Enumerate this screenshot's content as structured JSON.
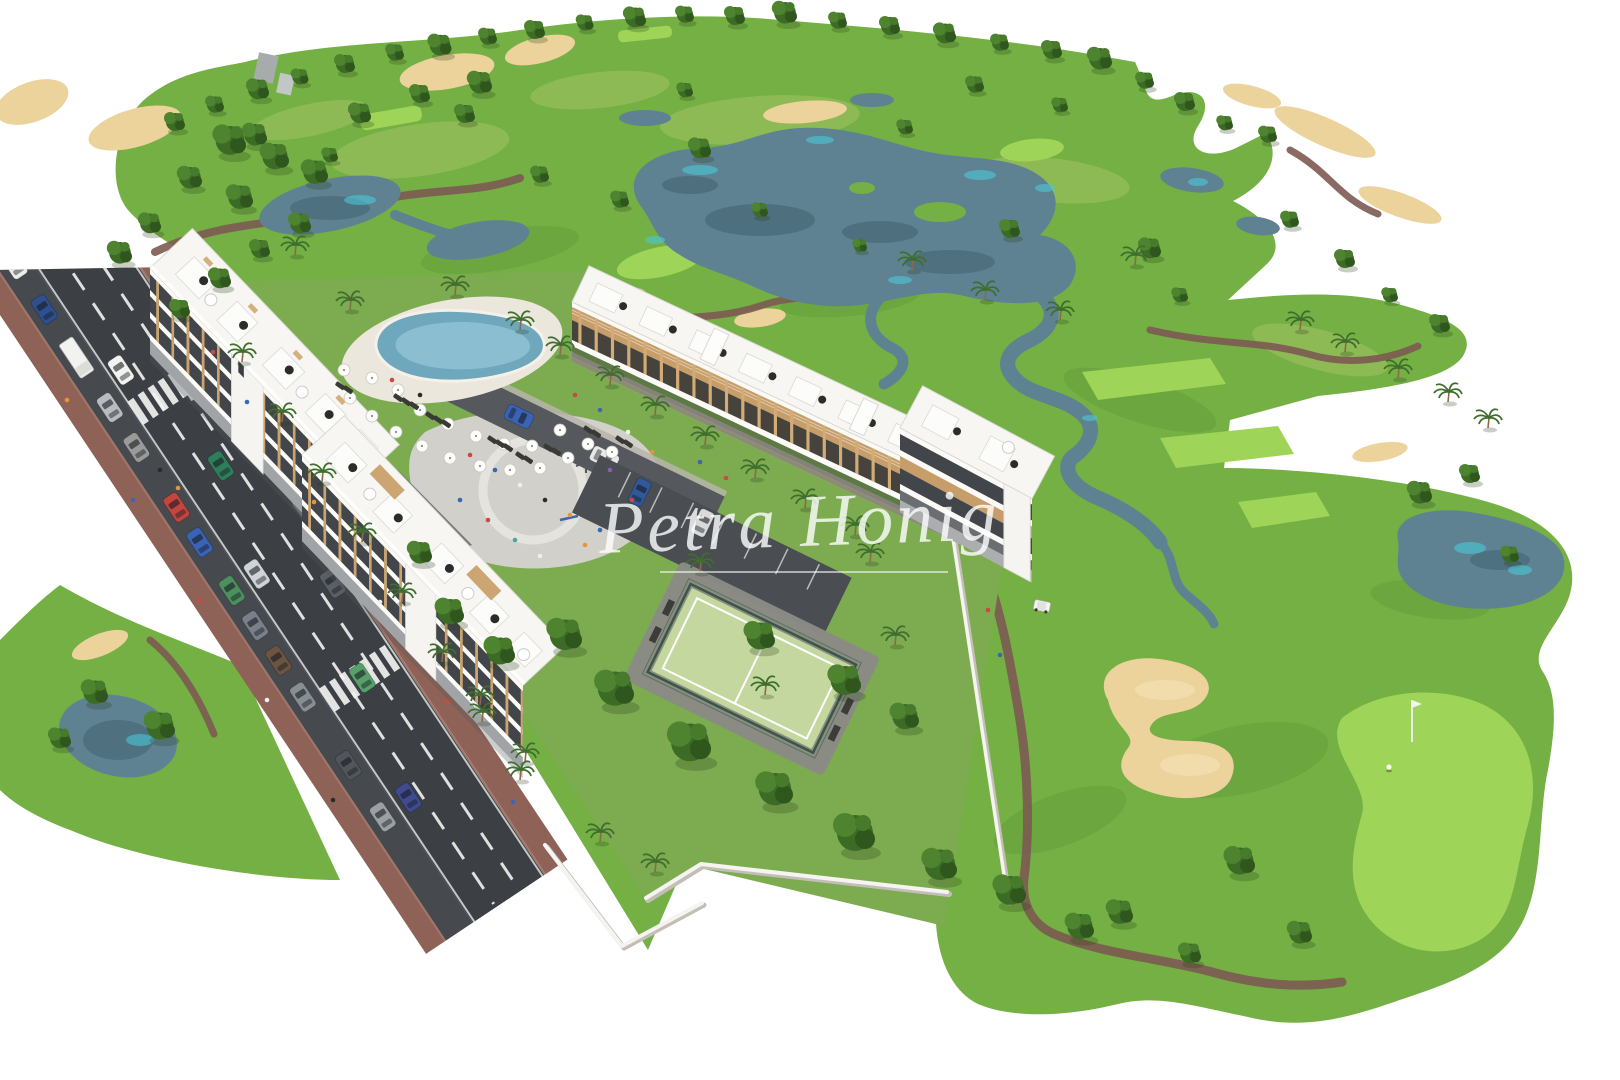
{
  "watermark": {
    "text": "Petra Honig",
    "color": "#ffffff"
  },
  "palette": {
    "background": "#ffffff",
    "fairway": "#74b043",
    "lawn": "#7cab50",
    "green_light": "#9ed457",
    "rough": "#a8c46b",
    "sand": "#ecd29b",
    "water": "#5f8292",
    "water_teal": "#49c8d8",
    "road_asphalt": "#3c4045",
    "sidewalk": "#8f6257",
    "cart_path": "#7d5a52",
    "building_white": "#f7f6f2",
    "wood": "#c9a06b",
    "window_dark": "#43474b",
    "pool_water": "#6fa7bd",
    "court_surface": "#c3d79e",
    "wall_white": "#f6f4f0"
  },
  "scene": {
    "horizon_trees": [
      [
        175,
        128,
        1
      ],
      [
        215,
        110,
        0.9
      ],
      [
        258,
        96,
        1.1
      ],
      [
        300,
        82,
        0.85
      ],
      [
        345,
        70,
        1
      ],
      [
        395,
        58,
        0.9
      ],
      [
        440,
        52,
        1.15
      ],
      [
        488,
        42,
        0.9
      ],
      [
        535,
        36,
        1
      ],
      [
        585,
        28,
        0.85
      ],
      [
        635,
        24,
        1.1
      ],
      [
        685,
        20,
        0.9
      ],
      [
        735,
        22,
        1
      ],
      [
        785,
        20,
        1.2
      ],
      [
        838,
        26,
        0.9
      ],
      [
        890,
        32,
        1
      ],
      [
        945,
        40,
        1.1
      ],
      [
        1000,
        48,
        0.9
      ],
      [
        1052,
        56,
        1
      ],
      [
        1100,
        66,
        1.2
      ],
      [
        1145,
        86,
        0.9
      ],
      [
        1185,
        108,
        1
      ],
      [
        1225,
        128,
        0.8
      ],
      [
        1268,
        140,
        0.9
      ]
    ],
    "course_trees": [
      [
        255,
        142,
        1.2
      ],
      [
        330,
        160,
        0.8
      ],
      [
        465,
        120,
        1
      ],
      [
        540,
        180,
        0.9
      ],
      [
        700,
        155,
        1.1
      ],
      [
        905,
        132,
        0.8
      ],
      [
        620,
        205,
        0.9
      ],
      [
        1010,
        235,
        1
      ],
      [
        1150,
        255,
        1.1
      ],
      [
        1290,
        225,
        0.9
      ],
      [
        1345,
        265,
        1
      ],
      [
        1180,
        300,
        0.8
      ],
      [
        860,
        250,
        0.7
      ],
      [
        760,
        215,
        0.8
      ],
      [
        1440,
        330,
        1
      ],
      [
        1390,
        300,
        0.8
      ],
      [
        685,
        95,
        0.8
      ],
      [
        975,
        90,
        0.9
      ],
      [
        1060,
        110,
        0.8
      ]
    ],
    "cluster_trees": [
      [
        565,
        645,
        1.7
      ],
      [
        615,
        700,
        1.9
      ],
      [
        690,
        755,
        2.1
      ],
      [
        775,
        800,
        1.8
      ],
      [
        855,
        845,
        2
      ],
      [
        940,
        875,
        1.7
      ],
      [
        760,
        645,
        1.5
      ],
      [
        845,
        690,
        1.6
      ],
      [
        905,
        725,
        1.4
      ],
      [
        1010,
        900,
        1.6
      ],
      [
        1080,
        935,
        1.4
      ],
      [
        450,
        620,
        1.4
      ],
      [
        500,
        660,
        1.5
      ],
      [
        420,
        560,
        1.2
      ],
      [
        230,
        150,
        1.6
      ],
      [
        275,
        165,
        1.4
      ],
      [
        315,
        180,
        1.3
      ],
      [
        190,
        185,
        1.2
      ],
      [
        240,
        205,
        1.3
      ],
      [
        150,
        230,
        1.1
      ],
      [
        120,
        260,
        1.2
      ],
      [
        300,
        230,
        1.1
      ],
      [
        260,
        255,
        1
      ],
      [
        220,
        285,
        1.1
      ],
      [
        180,
        315,
        1
      ],
      [
        360,
        120,
        1.1
      ],
      [
        420,
        100,
        1
      ],
      [
        480,
        90,
        1.2
      ],
      [
        95,
        700,
        1.3
      ],
      [
        160,
        735,
        1.5
      ],
      [
        60,
        745,
        1.1
      ],
      [
        1240,
        870,
        1.5
      ],
      [
        1300,
        940,
        1.2
      ],
      [
        1190,
        960,
        1.1
      ],
      [
        1120,
        920,
        1.3
      ],
      [
        1420,
        500,
        1.2
      ],
      [
        1470,
        480,
        1
      ],
      [
        1510,
        560,
        0.9
      ]
    ],
    "palms": [
      [
        350,
        310
      ],
      [
        520,
        330
      ],
      [
        560,
        355
      ],
      [
        455,
        295
      ],
      [
        610,
        385
      ],
      [
        655,
        415
      ],
      [
        705,
        445
      ],
      [
        755,
        478
      ],
      [
        805,
        508
      ],
      [
        855,
        535
      ],
      [
        700,
        572
      ],
      [
        870,
        562
      ],
      [
        765,
        695
      ],
      [
        895,
        645
      ],
      [
        480,
        705
      ],
      [
        525,
        762
      ],
      [
        600,
        842
      ],
      [
        655,
        872
      ],
      [
        1300,
        330
      ],
      [
        1345,
        352
      ],
      [
        1398,
        378
      ],
      [
        1448,
        402
      ],
      [
        1488,
        428
      ],
      [
        295,
        255
      ],
      [
        242,
        362
      ],
      [
        282,
        422
      ],
      [
        322,
        482
      ],
      [
        362,
        542
      ],
      [
        402,
        602
      ],
      [
        442,
        662
      ],
      [
        482,
        722
      ],
      [
        520,
        780
      ],
      [
        985,
        300
      ],
      [
        1060,
        320
      ],
      [
        912,
        270
      ],
      [
        1135,
        265
      ]
    ],
    "pool": {
      "umbrellas": [
        [
          350,
          398
        ],
        [
          372,
          416
        ],
        [
          396,
          432
        ],
        [
          422,
          446
        ],
        [
          450,
          458
        ],
        [
          480,
          466
        ],
        [
          510,
          470
        ],
        [
          540,
          468
        ],
        [
          568,
          458
        ],
        [
          420,
          410
        ],
        [
          448,
          424
        ],
        [
          476,
          436
        ],
        [
          504,
          444
        ],
        [
          532,
          446
        ],
        [
          372,
          378
        ],
        [
          344,
          370
        ],
        [
          560,
          430
        ],
        [
          588,
          444
        ],
        [
          612,
          452
        ],
        [
          398,
          390
        ]
      ],
      "loungers": [
        [
          398,
          398
        ],
        [
          406,
          402
        ],
        [
          414,
          406
        ],
        [
          430,
          416
        ],
        [
          438,
          420
        ],
        [
          446,
          424
        ],
        [
          492,
          440
        ],
        [
          500,
          444
        ],
        [
          508,
          448
        ],
        [
          548,
          448
        ],
        [
          556,
          452
        ],
        [
          340,
          386
        ],
        [
          348,
          390
        ],
        [
          588,
          430
        ],
        [
          596,
          434
        ],
        [
          620,
          440
        ],
        [
          628,
          444
        ],
        [
          520,
          456
        ],
        [
          528,
          460
        ]
      ]
    },
    "people": [
      [
        470,
        455,
        "#c84a42"
      ],
      [
        495,
        470,
        "#3b66b0"
      ],
      [
        520,
        485,
        "#f0efec"
      ],
      [
        545,
        500,
        "#2b2b2b"
      ],
      [
        570,
        515,
        "#e6953a"
      ],
      [
        460,
        500,
        "#3b66b0"
      ],
      [
        488,
        520,
        "#c84a42"
      ],
      [
        515,
        540,
        "#49a7a0"
      ],
      [
        540,
        556,
        "#f0efec"
      ],
      [
        610,
        470,
        "#8a5fb0"
      ],
      [
        632,
        500,
        "#c84a42"
      ],
      [
        600,
        530,
        "#3b66b0"
      ],
      [
        655,
        527,
        "#2b2b2b"
      ],
      [
        585,
        545,
        "#e6953a"
      ],
      [
        575,
        395,
        "#c84a42"
      ],
      [
        600,
        410,
        "#3b66b0"
      ],
      [
        628,
        432,
        "#f0efec"
      ],
      [
        652,
        452,
        "#e6953a"
      ],
      [
        420,
        395,
        "#2b2b2b"
      ],
      [
        392,
        380,
        "#c84a42"
      ],
      [
        700,
        462,
        "#3b66b0"
      ],
      [
        726,
        478,
        "#c84a42"
      ],
      [
        67,
        400,
        "#e6953a"
      ],
      [
        133,
        500,
        "#3b66b0"
      ],
      [
        200,
        600,
        "#c84a42"
      ],
      [
        267,
        700,
        "#f0efec"
      ],
      [
        333,
        800,
        "#2b2b2b"
      ],
      [
        213,
        352,
        "#c84a42"
      ],
      [
        247,
        402,
        "#3b66b0"
      ],
      [
        314,
        502,
        "#e6953a"
      ],
      [
        380,
        602,
        "#f0efec"
      ],
      [
        447,
        702,
        "#c84a42"
      ],
      [
        513,
        802,
        "#3b66b0"
      ],
      [
        988,
        610,
        "#c84a42"
      ],
      [
        1000,
        655,
        "#3b66b0"
      ],
      [
        160,
        470,
        "#2b2b2b"
      ],
      [
        178,
        488,
        "#e6953a"
      ]
    ],
    "road": {
      "parked_cars": [
        [
          38,
          "#ececea"
        ],
        [
          92,
          "#2f4f8f"
        ],
        [
          210,
          "#b8bcbe"
        ],
        [
          258,
          "#9a9a9a"
        ],
        [
          330,
          "#c2453f"
        ],
        [
          372,
          "#3a62b5"
        ],
        [
          430,
          "#4d8f5f"
        ],
        [
          472,
          "#79808a"
        ],
        [
          514,
          "#6b5442"
        ],
        [
          558,
          "#888f94"
        ],
        [
          640,
          "#50565c"
        ],
        [
          702,
          "#9aa0a4"
        ]
      ],
      "truck_y": 150,
      "moving_cars": [
        [
          70,
          185,
          "#f2f2f0"
        ],
        [
          100,
          320,
          "#2e7d5b"
        ],
        [
          70,
          430,
          "#cfd4d8"
        ],
        [
          100,
          575,
          "#57a06a"
        ],
        [
          72,
          700,
          "#3f4a8f"
        ],
        [
          128,
          250,
          "#d8d8d6"
        ],
        [
          128,
          480,
          "#5a5e66"
        ]
      ],
      "crosswalk_y": [
        215,
        560
      ]
    }
  }
}
